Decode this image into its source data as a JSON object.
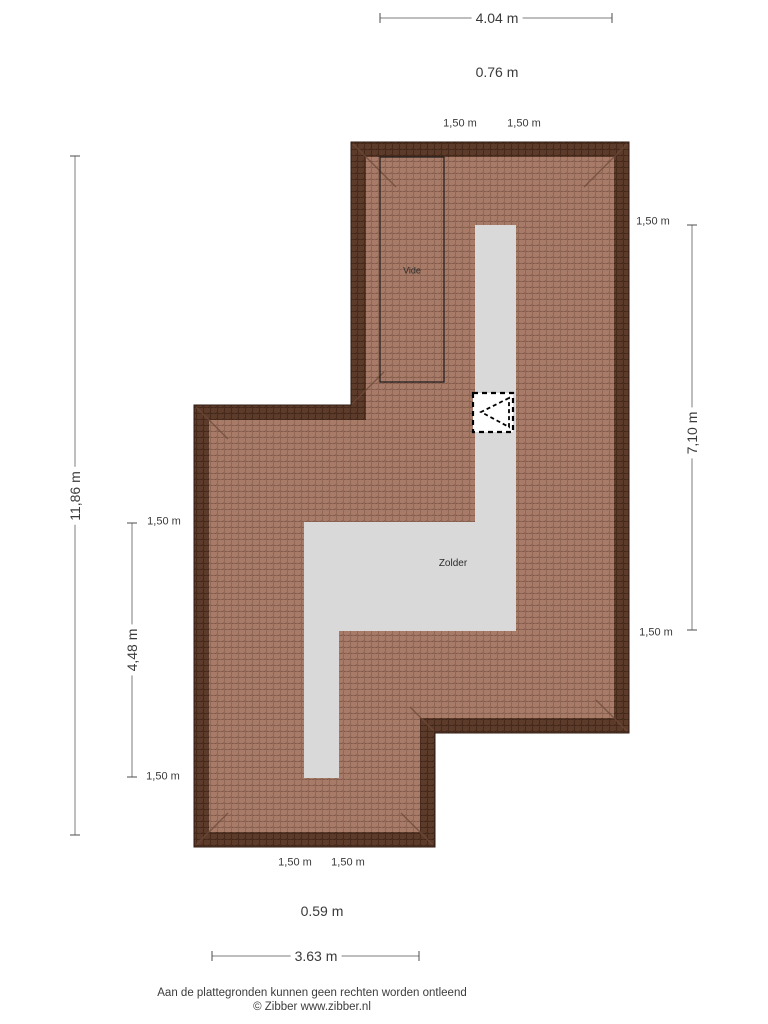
{
  "rooms": {
    "vide": "Vide",
    "zolder": "Zolder"
  },
  "dims": {
    "width_top": "4.04 m",
    "offset_top": "0.76 m",
    "seg_top_left": "1,50 m",
    "seg_top_right": "1,50 m",
    "seg_right_top": "1,50 m",
    "height_right": "7,10 m",
    "seg_right_bottom": "1,50 m",
    "height_total": "11,86 m",
    "seg_left_top": "1,50 m",
    "height_left_inner": "4,48 m",
    "seg_left_bottom": "1,50 m",
    "seg_bottom_left": "1,50 m",
    "seg_bottom_right": "1,50 m",
    "offset_bottom": "0.59 m",
    "width_bottom": "3.63 m"
  },
  "footer": {
    "disclaimer": "Aan de plattegronden kunnen geen rechten worden ontleend",
    "credit": "© Zibber www.zibber.nl"
  },
  "icons": {
    "roof_window": "roof-window-icon"
  },
  "colors": {
    "roof_edge": "#5d3b2b",
    "roof_tile": "#a87b69",
    "roof_grout": "#7b5545",
    "floor": "#d9d9d9",
    "dim_line": "#7d7d7d",
    "text": "#3a3a3a"
  }
}
